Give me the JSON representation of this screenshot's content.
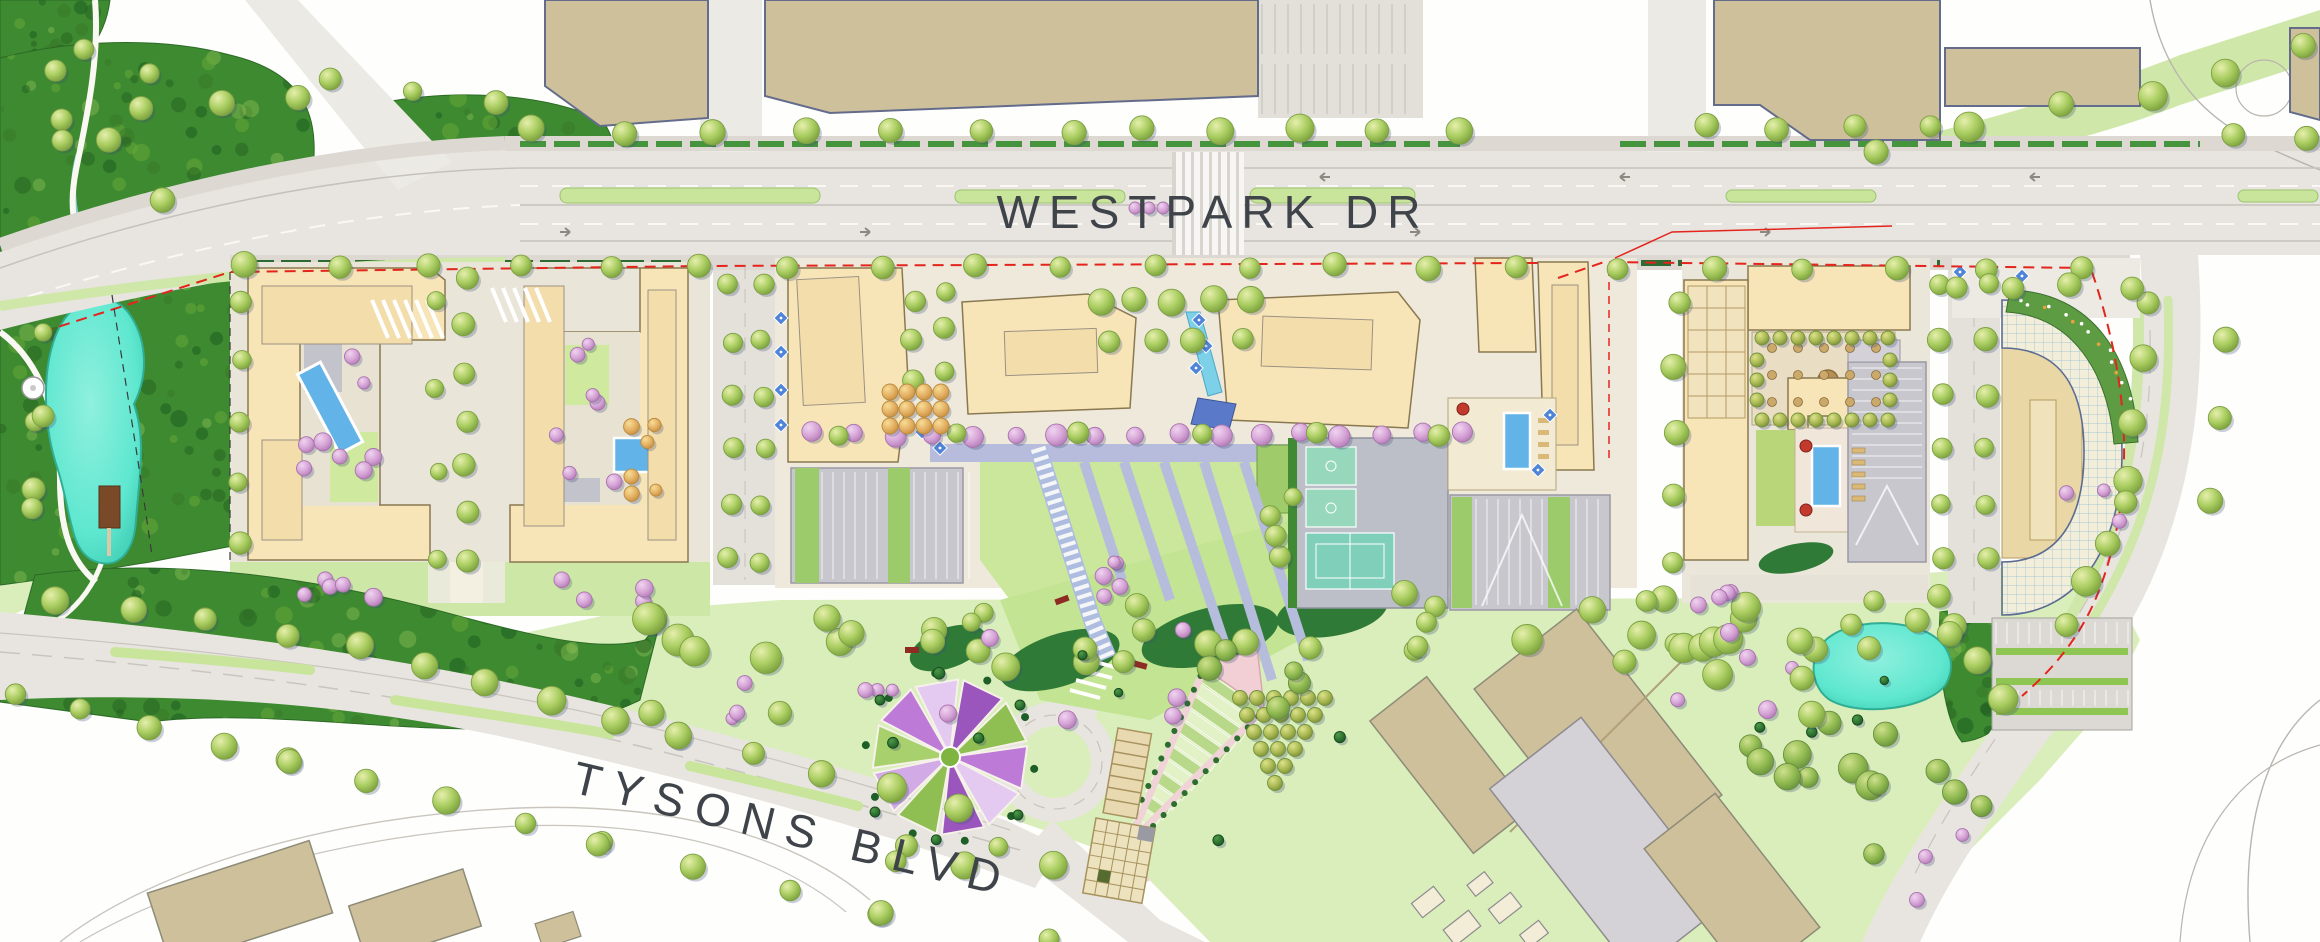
{
  "map": {
    "type": "illustrated-site-plan",
    "streets": {
      "westpark": {
        "label": "WESTPARK DR"
      },
      "tysons": {
        "label": "TYSONS BLVD"
      }
    },
    "colors": {
      "road": "#e8e5e0",
      "sidewalk": "#ddd9d2",
      "plaza": "#eee9db",
      "lawn": "#cde9a0",
      "meadow": "#d9eebb",
      "forest": "#3e8a31",
      "pond": "#5ee7cf",
      "pool": "#62b4e8",
      "water_feature": "#7cd0e8",
      "building": "#f7e5b8",
      "building_outline": "#8a7850",
      "existing_building": "#cec09b",
      "existing_outline": "#646c8c",
      "parking_deck": "#c8c7ce",
      "basketball_court": "#97d8bd",
      "tennis_court": "#7fcfba",
      "path_lavender": "#b7bcdc",
      "tree_green": "#a9cd60",
      "tree_pink": "#d9aadb",
      "tree_orange": "#e8b968",
      "shrub": "#2f7a36",
      "property_line": "#e3251d",
      "label_text": "#3f444a"
    }
  }
}
